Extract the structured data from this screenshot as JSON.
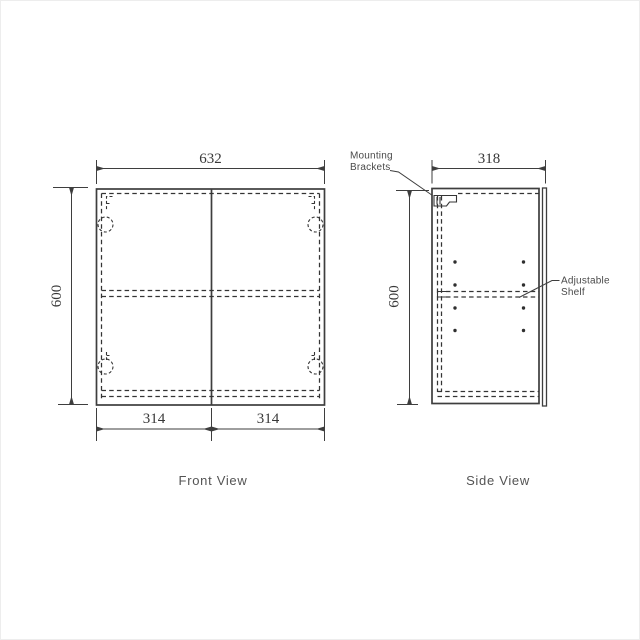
{
  "page": {
    "background_color": "#ffffff",
    "line_color": "#3e3e3e",
    "text_color": "#4a4a4a"
  },
  "front_view": {
    "title": "Front View",
    "width_label": "632",
    "height_label": "600",
    "left_door_label": "314",
    "right_door_label": "314"
  },
  "side_view": {
    "title": "Side View",
    "depth_label": "318",
    "height_label": "600"
  },
  "callouts": {
    "mounting_brackets_line1": "Mounting",
    "mounting_brackets_line2": "Brackets",
    "adjustable_shelf_line1": "Adjustable",
    "adjustable_shelf_line2": "Shelf"
  }
}
